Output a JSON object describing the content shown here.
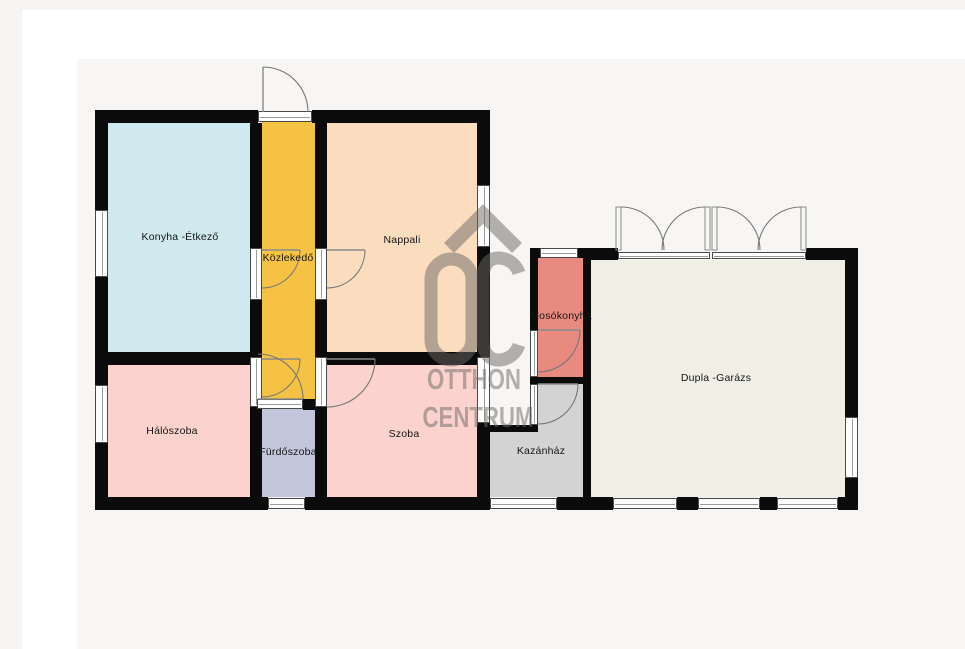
{
  "plan": {
    "title": "Floor plan",
    "rooms": [
      {
        "id": "konyha",
        "label": "Konyha -Étkező",
        "color": "#cfe9ee"
      },
      {
        "id": "kozlekedo",
        "label": "Közlekedő",
        "color": "#f5c243"
      },
      {
        "id": "nappali",
        "label": "Nappali",
        "color": "#fadcbe"
      },
      {
        "id": "haloszoba",
        "label": "Hálószoba",
        "color": "#fbd2ce"
      },
      {
        "id": "furdoszoba",
        "label": "Fürdőszoba",
        "color": "#c3c6da"
      },
      {
        "id": "szoba",
        "label": "Szoba",
        "color": "#fbd2ce"
      },
      {
        "id": "mosokonyha",
        "label": "Mosókonyha",
        "color": "#e98a80"
      },
      {
        "id": "kazanhaz",
        "label": "Kazánház",
        "color": "#d3d3d3"
      },
      {
        "id": "garazs",
        "label": "Dupla -Garázs",
        "color": "#f0efe6"
      }
    ],
    "watermark": {
      "logo": "OC",
      "line1": "OTTHON",
      "line2": "CENTRUM"
    },
    "colors": {
      "wall": "#0b0b0b",
      "plan_bg": "#f7f6f4",
      "page_bg": "#f6f5f3",
      "card_bg": "#ffffff",
      "door_line": "#777777",
      "watermark": "#6e6a66"
    }
  }
}
